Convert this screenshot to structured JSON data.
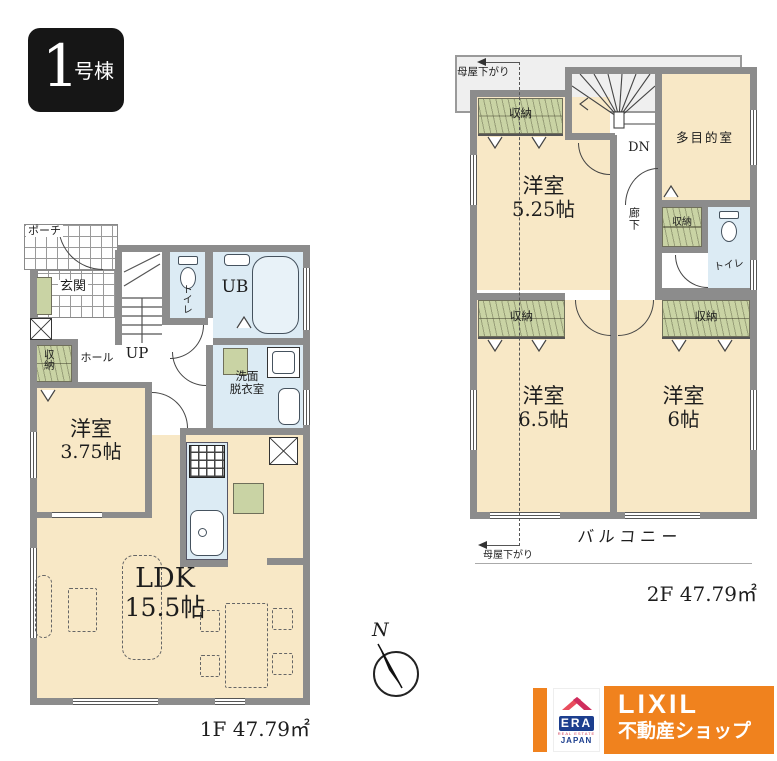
{
  "badge": {
    "number": "1",
    "suffix": "号棟"
  },
  "f1": {
    "area": "1F 47.79㎡",
    "porch": "ポーチ",
    "entrance": "玄関",
    "hall": "ホール",
    "stairs_up": "UP",
    "toilet": "トイレ",
    "bath": "UB",
    "washroom_l1": "洗面",
    "washroom_l2": "脱衣室",
    "closet": "収納",
    "bedroom": "洋室",
    "bedroom_size": "3.75帖",
    "ldk": "LDK",
    "ldk_size": "15.5帖"
  },
  "f2": {
    "area": "2F 47.79㎡",
    "moya_sagari": "母屋下がり",
    "stairs_dn": "DN",
    "closet": "収納",
    "multipurpose": "多目的室",
    "bedroom1": "洋室",
    "bedroom1_size": "5.25帖",
    "corridor": "廊下",
    "toilet": "トイレ",
    "bedroom2": "洋室",
    "bedroom2_size": "6.5帖",
    "bedroom3": "洋室",
    "bedroom3_size": "6帖",
    "balcony": "バルコニー"
  },
  "compass": {
    "north": "N"
  },
  "logo": {
    "brand": "LIXIL",
    "brand_sub": "不動産ショップ",
    "era": "ERA",
    "era_tagline": "REAL ESTATE",
    "era_region": "JAPAN"
  },
  "colors": {
    "wall": "#8c8c8c",
    "room_cream": "#f8e8c6",
    "wet_blue": "#dcebf4",
    "closet_green": "#c9d3a4",
    "balcony_gray": "#efefef",
    "brand_orange": "#f0821e",
    "era_navy": "#1c3e8e",
    "era_red": "#e23c4e"
  }
}
